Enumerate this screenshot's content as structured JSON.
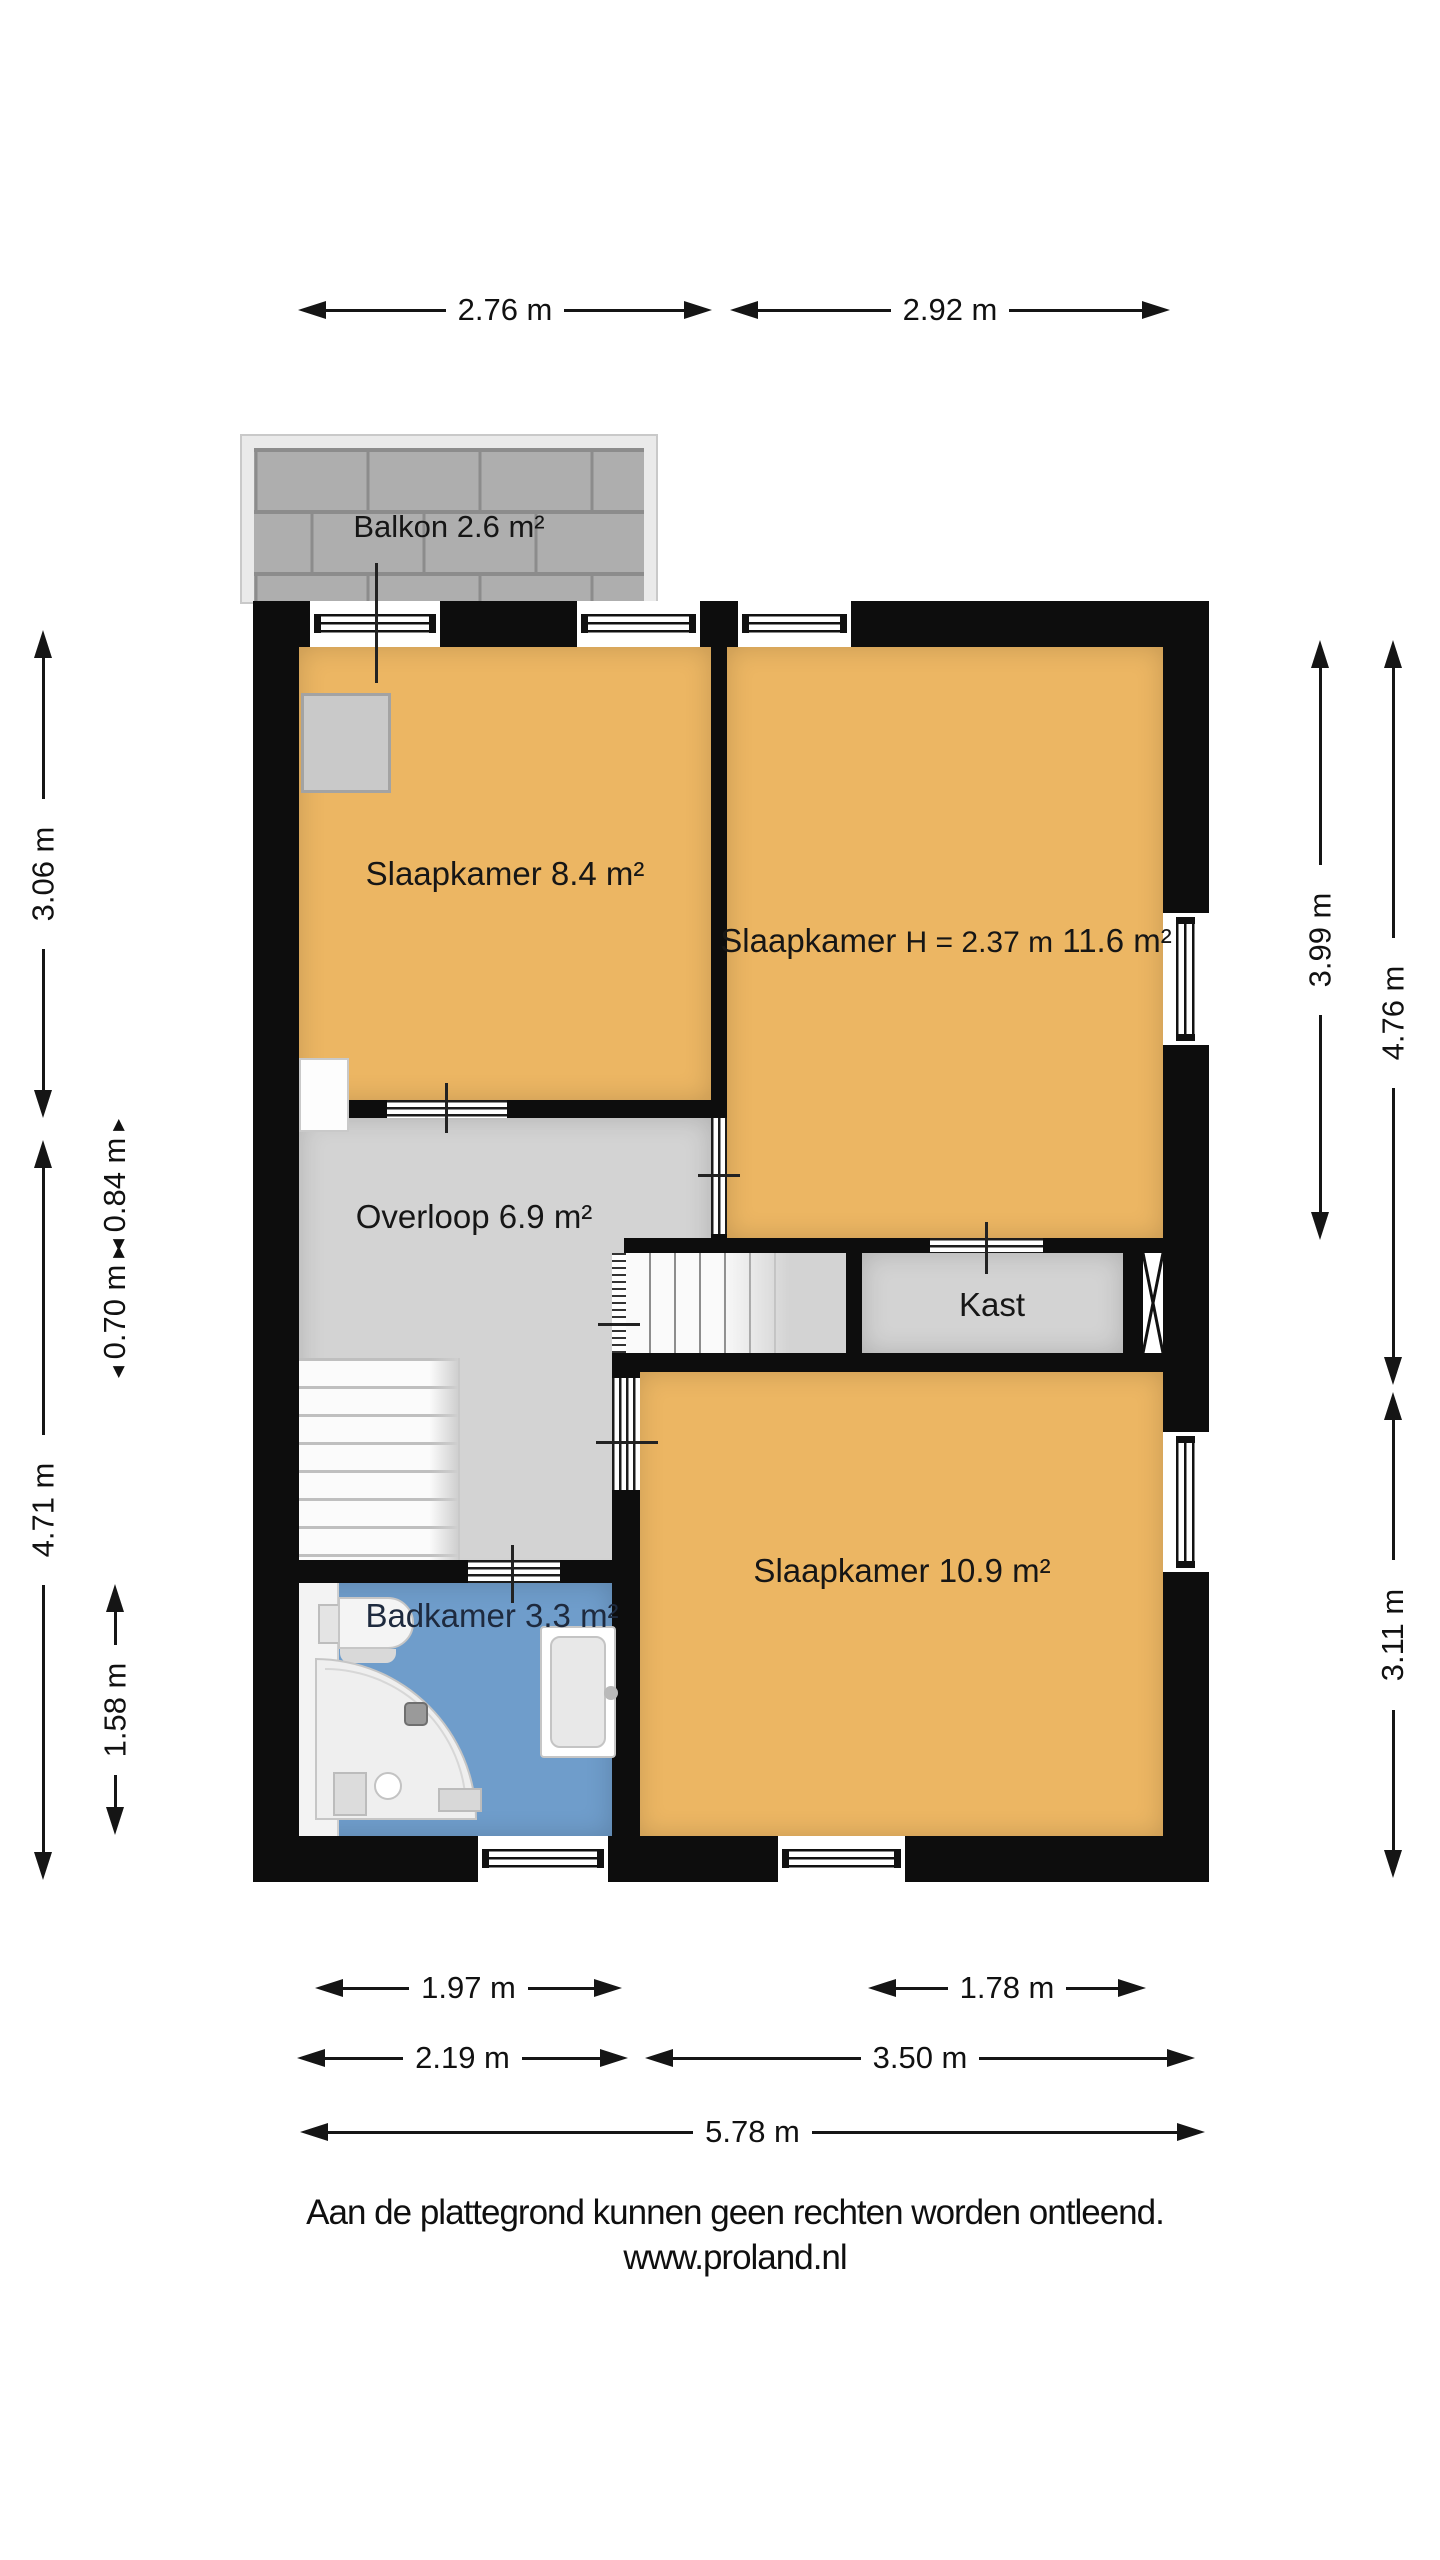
{
  "plan": {
    "rooms": {
      "balkon": {
        "name": "Balkon",
        "area": "2.6 m²"
      },
      "slaapkamer_links": {
        "name": "Slaapkamer",
        "area": "8.4 m²"
      },
      "slaapkamer_rechts": {
        "name": "Slaapkamer",
        "height": "H = 2.37 m",
        "area": "11.6 m²"
      },
      "overloop": {
        "name": "Overloop",
        "area": "6.9 m²"
      },
      "kast": {
        "name": "Kast"
      },
      "slaapkamer_onder": {
        "name": "Slaapkamer",
        "area": "10.9 m²"
      },
      "badkamer": {
        "name": "Badkamer",
        "area": "3.3 m²"
      }
    },
    "symbols": [
      "balcony-tiles",
      "wardrobe",
      "stairs-up",
      "stairs-main",
      "shaft-cross",
      "toilet",
      "shower",
      "bathtub"
    ]
  },
  "dimensions": {
    "top": [
      "2.76 m",
      "2.92 m"
    ],
    "left_outer": [
      "3.06 m",
      "4.71 m"
    ],
    "left_inner": [
      "0.84 m",
      "0.70 m",
      "1.58 m"
    ],
    "right_inner": [
      "3.99 m"
    ],
    "right_outer": [
      "4.76 m",
      "3.11 m"
    ],
    "bottom_row1": [
      "1.97 m",
      "1.78 m"
    ],
    "bottom_row2": [
      "2.19 m",
      "3.50 m"
    ],
    "bottom_row3": [
      "5.78 m"
    ]
  },
  "footer": {
    "line1": "Aan de plattegrond kunnen geen rechten worden ontleend.",
    "line2": "www.proland.nl"
  },
  "colors": {
    "wall": "#0d0d0d",
    "bedroom": "#ecb663",
    "floor": "#d3d3d3",
    "bathroom": "#6f9dcb",
    "tile": "#aeaeae",
    "tile_joint": "#8c8c8c",
    "balcony_frame": "#eaeaea"
  }
}
